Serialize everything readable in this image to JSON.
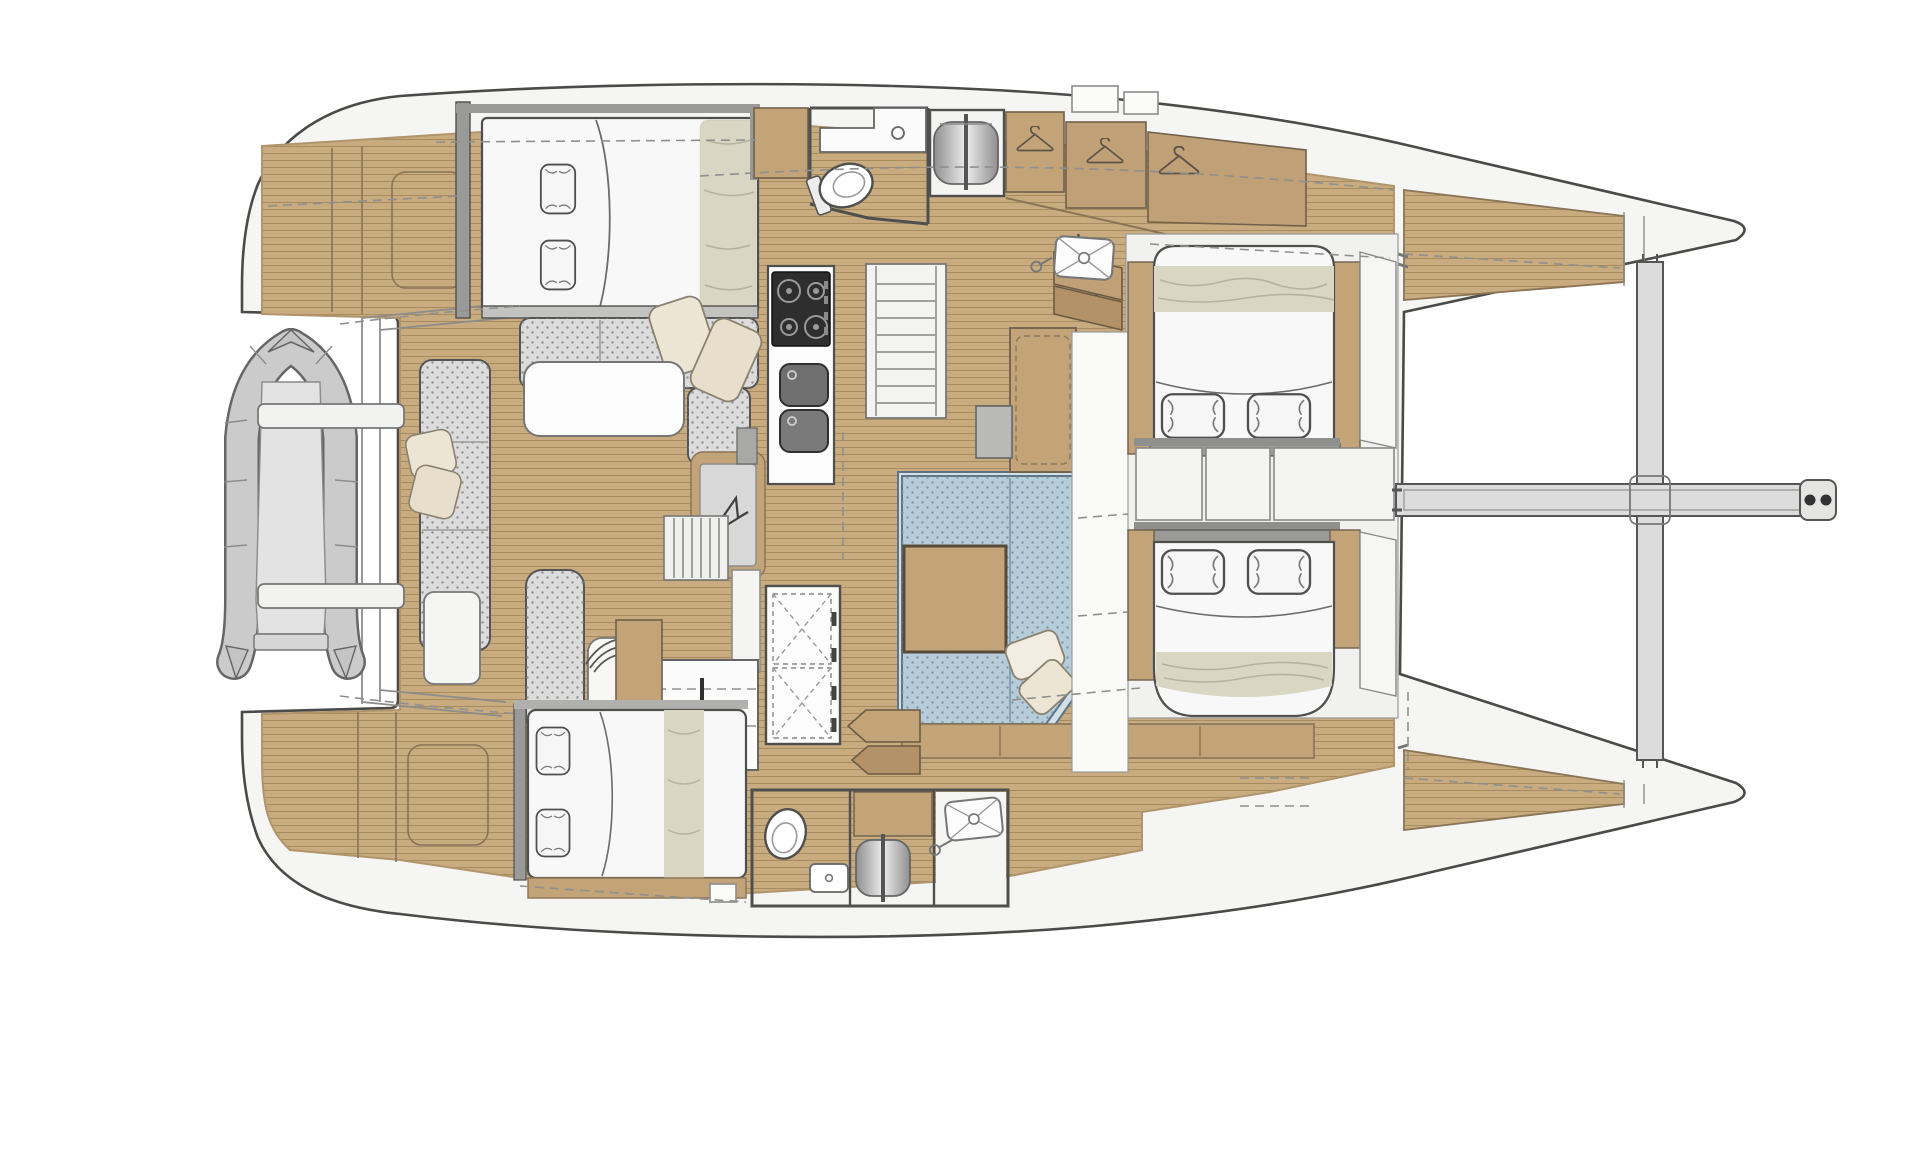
{
  "document": {
    "type": "floor-plan-diagram",
    "subject": "catamaran-yacht-interior-layout",
    "view": "top-down-plan",
    "bow_direction": "right",
    "visible_text": []
  },
  "colors": {
    "page_bg": "#ffffff",
    "hull": "#f5f5f3",
    "hull_stroke": "#4a4a48",
    "teak": "#c9ab80",
    "teak_line": "#a78c60",
    "teak_dark": "#b3926a",
    "wood_tan": "#c2a478",
    "wood_stroke": "#70604a",
    "wall_gray": "#9a9a98",
    "cushion_gray": "#dcdcdc",
    "cushion_dot": "#8f8f8f",
    "sofa_blue": "#b7ccd9",
    "sofa_blue_dot": "#7e97a8",
    "sofa_blue_edge": "#d3e0e8",
    "bed_white": "#f8f8f8",
    "blanket_beige": "#d9d6c4",
    "pillow_cream": "#ece5d3",
    "stove_dark": "#2e2e2e",
    "sink_gray": "#6f6f6f",
    "beam_gray": "#dcdcdc",
    "dinghy_gray": "#cbcbcb",
    "grate_gray": "#d8d8d8"
  },
  "features": [
    {
      "id": "hull",
      "label": "catamaran hull outline with twin bows"
    },
    {
      "id": "trampoline-gap",
      "label": "open foredeck gap between hulls"
    },
    {
      "id": "crossbeam",
      "label": "forward crossbeam between bows"
    },
    {
      "id": "bowsprit",
      "label": "center bowsprit with bridle lines"
    },
    {
      "id": "anchor-rollers",
      "label": "two anchor roller pins at bowsprit tip"
    },
    {
      "id": "bow-deck-top",
      "label": "port bow teak deck wedge"
    },
    {
      "id": "bow-deck-bottom",
      "label": "starboard bow teak deck wedge"
    },
    {
      "id": "dinghy",
      "label": "inflatable dinghy on stern davits"
    },
    {
      "id": "davits",
      "label": "two davit arms"
    },
    {
      "id": "transom-steps",
      "label": "curved transom step band"
    },
    {
      "id": "aft-deck",
      "label": "aft teak deck with locker hatches"
    },
    {
      "id": "owner-berth",
      "label": "aft double berth cabin"
    },
    {
      "id": "dinette-settee",
      "label": "U-shaped settee with table"
    },
    {
      "id": "dinette-table",
      "label": "white dinette table"
    },
    {
      "id": "galley",
      "label": "galley with 4-burner stove and double sink"
    },
    {
      "id": "companionway-port",
      "label": "stairs to port hull"
    },
    {
      "id": "companionway-starboard",
      "label": "stairs to starboard hull"
    },
    {
      "id": "entry-grate",
      "label": "entry grate mat with sail logo"
    },
    {
      "id": "salon-sofa",
      "label": "blue L-shaped salon sofa"
    },
    {
      "id": "salon-table",
      "label": "square wooden salon table"
    },
    {
      "id": "nav-station",
      "label": "navigation seat, wheel and desk"
    },
    {
      "id": "x-cabinet",
      "label": "tall cabinet with crossed door panels"
    },
    {
      "id": "port-head",
      "label": "port head with toilet, sink, shower column"
    },
    {
      "id": "starboard-head",
      "label": "starboard head with toilet, sink, shower column"
    },
    {
      "id": "shower-trays",
      "label": "two shower trays with drains"
    },
    {
      "id": "hanging-lockers",
      "label": "three hanging lockers with hanger symbols"
    },
    {
      "id": "port-forward-berth",
      "label": "port forward double berth"
    },
    {
      "id": "starboard-forward-berth",
      "label": "starboard forward double berth"
    },
    {
      "id": "starboard-aft-berth",
      "label": "starboard aft double berth"
    },
    {
      "id": "berth-cabinets",
      "label": "cabinet row between forward berths"
    },
    {
      "id": "deck-hatches",
      "label": "small white deck hatches"
    }
  ],
  "counts": {
    "double_berths": 4,
    "heads": 2,
    "shower_trays": 2,
    "shower_columns": 2,
    "hanging_lockers": 3,
    "galley_burners": 4,
    "galley_sinks": 2,
    "head_sinks": 2,
    "tables": 2,
    "anchor_rollers": 2,
    "dinghies": 1
  }
}
